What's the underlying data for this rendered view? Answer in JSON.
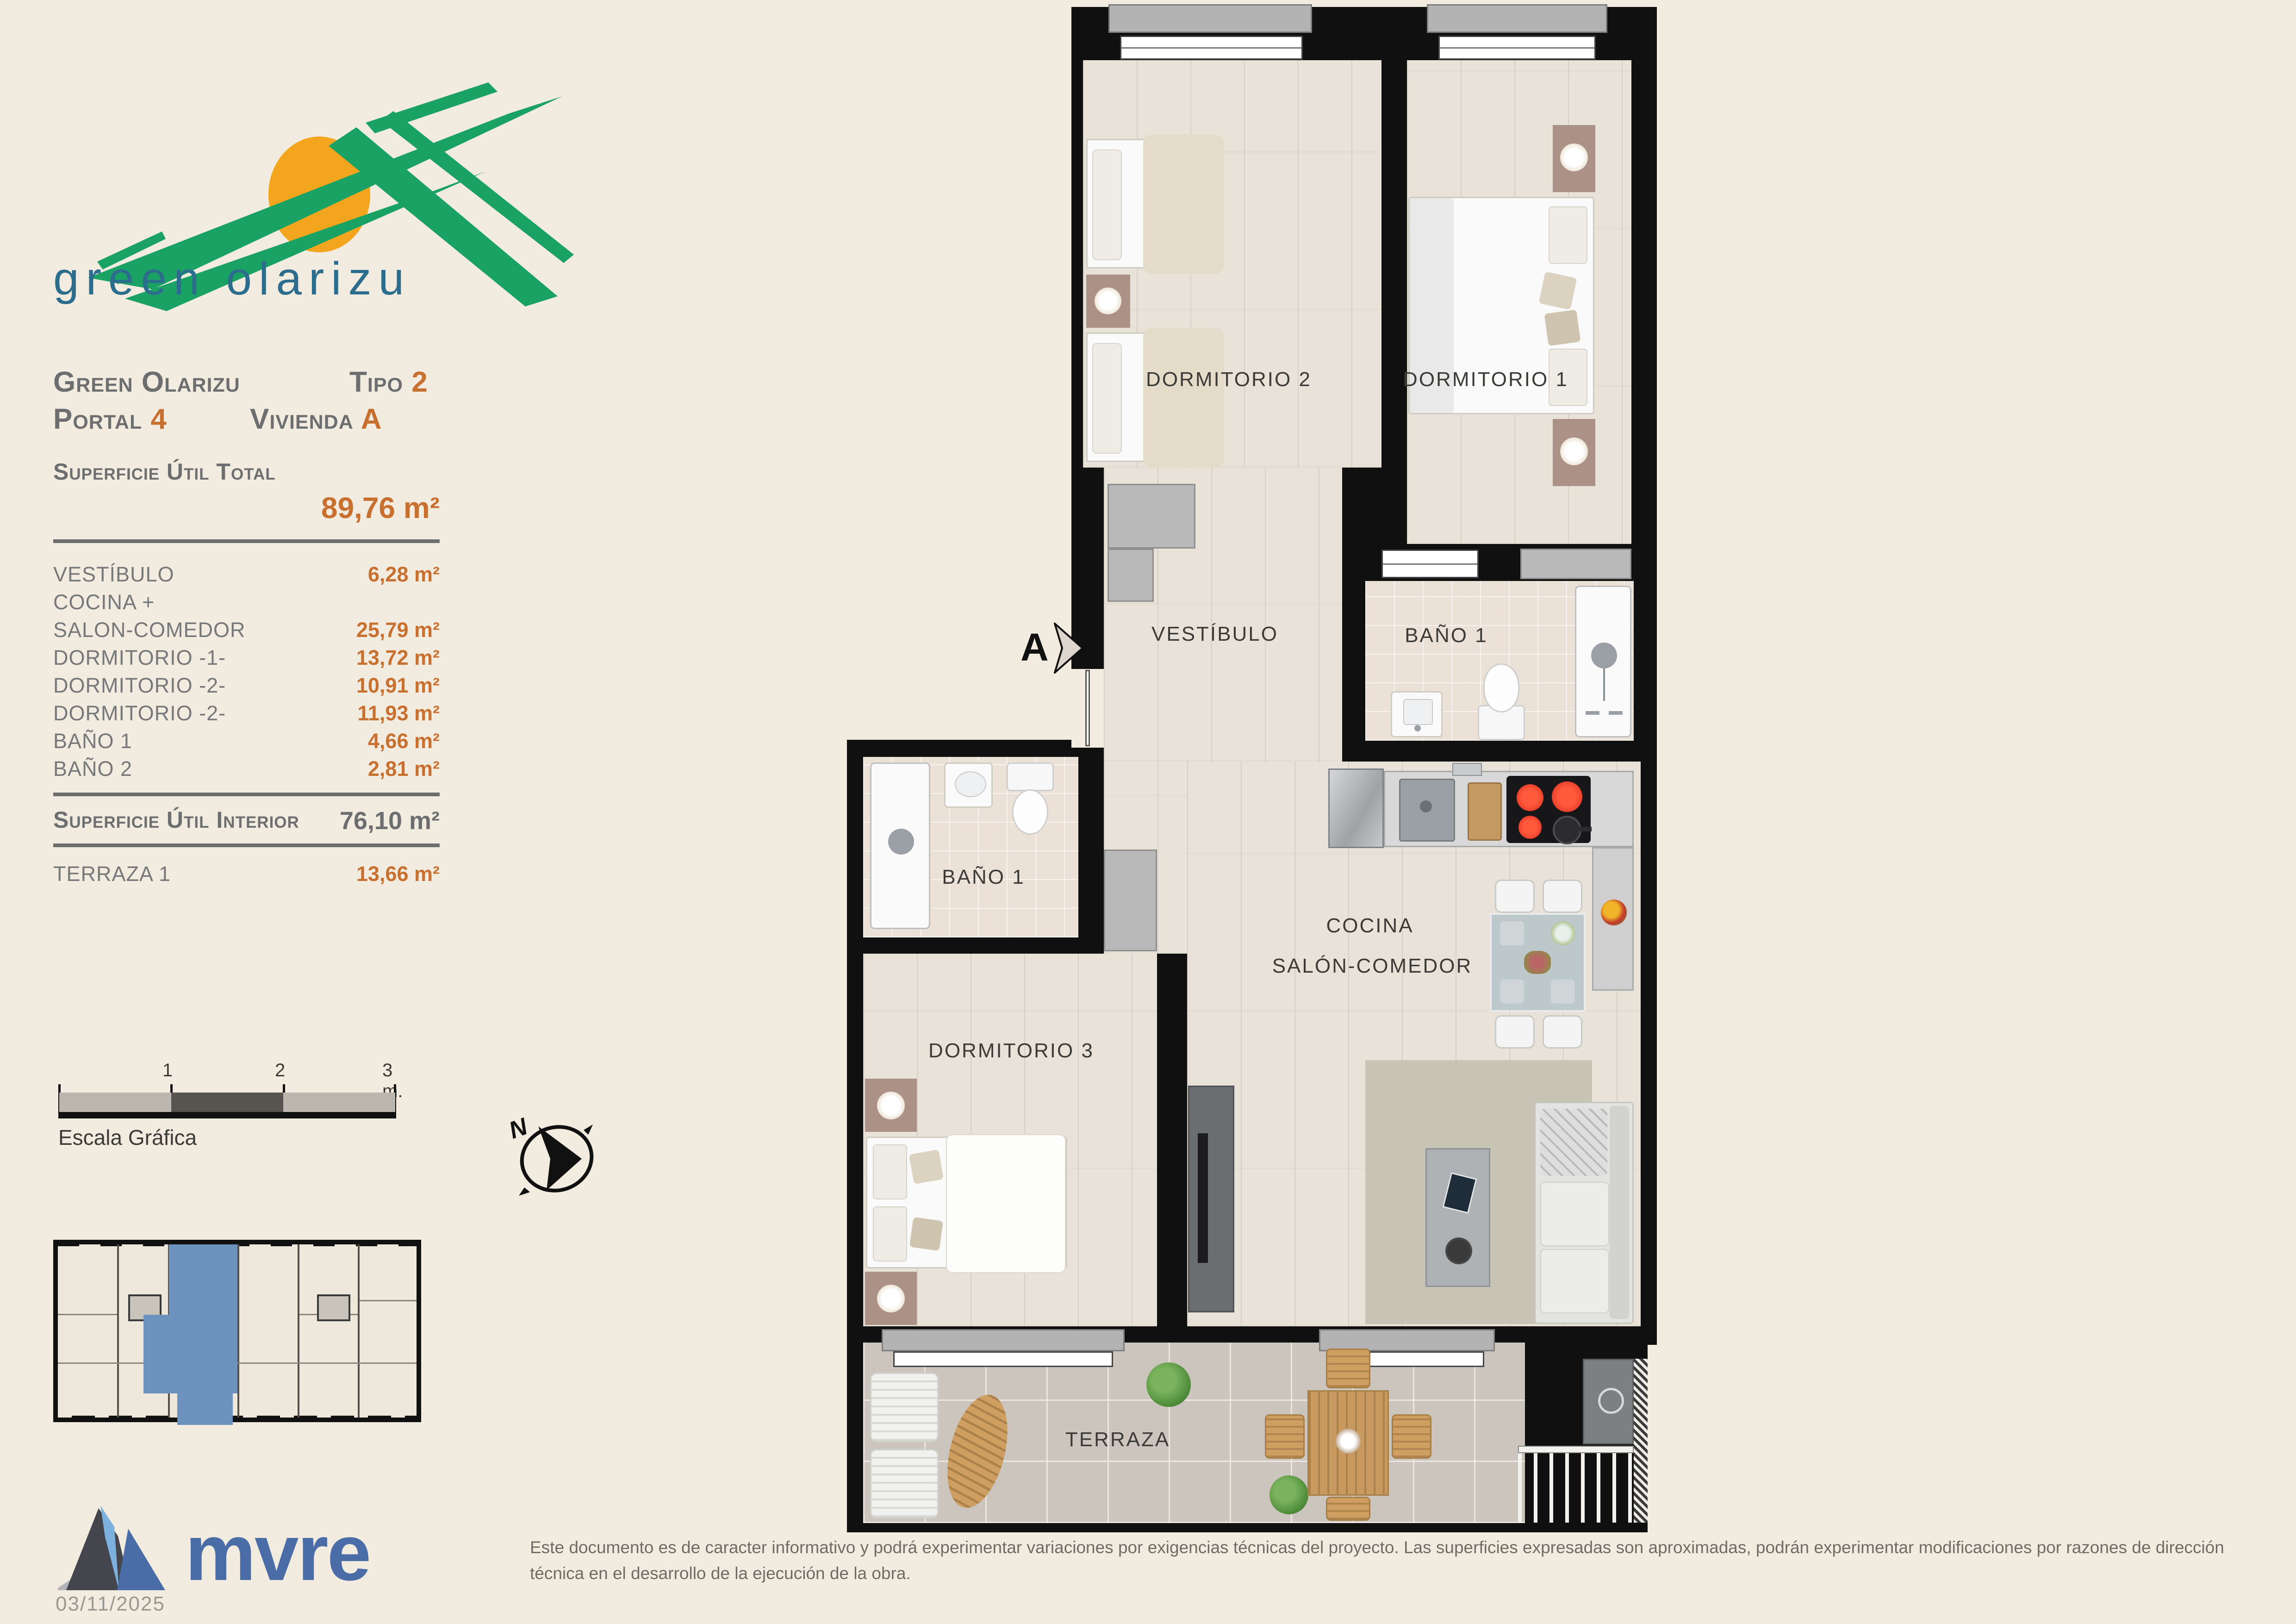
{
  "logo": {
    "name": "green olarizu"
  },
  "header": {
    "project": "Green Olarizu",
    "tipo_label": "Tipo",
    "tipo_value": "2",
    "portal_label": "Portal",
    "portal_value": "4",
    "vivienda_label": "Vivienda",
    "vivienda_value": "A"
  },
  "areas": {
    "total_label": "Superficie Útil Total",
    "total_value": "89,76 m²",
    "rows": [
      {
        "label": "VESTÍBULO",
        "value": "6,28 m²"
      },
      {
        "label": "COCINA +",
        "value": ""
      },
      {
        "label": "SALON-COMEDOR",
        "value": "25,79 m²"
      },
      {
        "label": "DORMITORIO -1-",
        "value": "13,72 m²"
      },
      {
        "label": "DORMITORIO -2-",
        "value": "10,91 m²"
      },
      {
        "label": "DORMITORIO -2-",
        "value": "11,93 m²"
      },
      {
        "label": "BAÑO 1",
        "value": "4,66 m²"
      },
      {
        "label": "BAÑO 2",
        "value": "2,81 m²"
      }
    ],
    "interior_label": "Superficie Útil Interior",
    "interior_value": "76,10 m²",
    "terraza_label": "TERRAZA 1",
    "terraza_value": "13,66 m²"
  },
  "scalebar": {
    "title": "Escala Gráfica",
    "t1": "1",
    "t2": "2",
    "t3": "3 m."
  },
  "compass": {
    "north": "N"
  },
  "plan": {
    "section_label": "A",
    "rooms": {
      "dormitorio2": "DORMITORIO 2",
      "dormitorio1": "DORMITORIO 1",
      "vestibulo": "VESTÍBULO",
      "bano1_top": "BAÑO 1",
      "bano1_left": "BAÑO 1",
      "cocina": "COCINA",
      "salon": "SALÓN-COMEDOR",
      "dormitorio3": "DORMITORIO 3",
      "terraza": "TERRAZA"
    }
  },
  "footer": {
    "brand": "mvre",
    "date": "03/11/2025",
    "disclaimer": "Este documento es de caracter informativo y podrá experimentar variaciones por exigencias técnicas del proyecto. Las superficies expresadas son aproximadas, podrán experimentar modificaciones por razones de dirección técnica en el desarrollo de la ejecución de la obra."
  },
  "colors": {
    "accent_orange": "#c8702f",
    "text_gray": "#6d6e70",
    "logo_green": "#19a263",
    "logo_sun": "#f3a51d",
    "logo_teal": "#2c6d8e",
    "brand_blue": "#4a6da7",
    "highlight_blue": "#6d92bd"
  }
}
